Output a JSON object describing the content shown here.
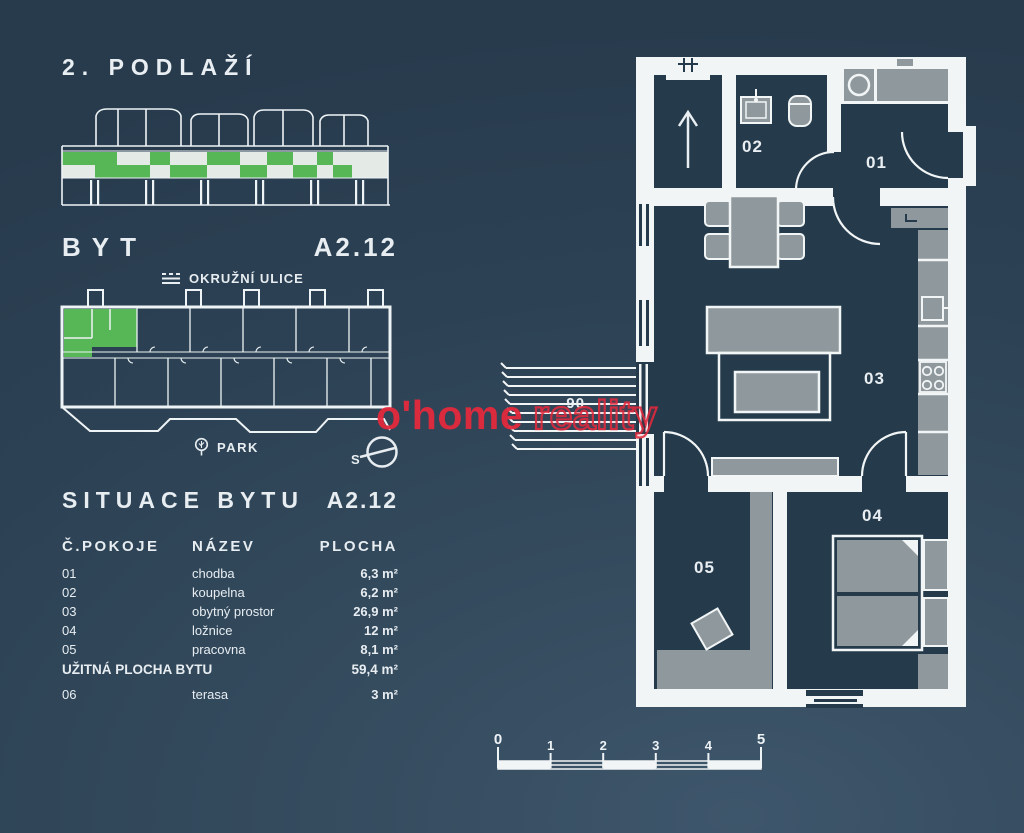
{
  "title": "2. PODLAŽÍ",
  "apartment": {
    "label": "BYT",
    "code": "A2.12"
  },
  "site": {
    "street": "OKRUŽNÍ ULICE",
    "park": "PARK",
    "compass_north": "S"
  },
  "situation": {
    "title": "SITUACE BYTU",
    "code": "A2.12"
  },
  "table": {
    "headers": {
      "room_no": "Č.POKOJE",
      "name": "NÁZEV",
      "area": "PLOCHA"
    },
    "rows": [
      {
        "num": "01",
        "name": "chodba",
        "area": "6,3 m²"
      },
      {
        "num": "02",
        "name": "koupelna",
        "area": "6,2 m²"
      },
      {
        "num": "03",
        "name": "obytný prostor",
        "area": "26,9 m²"
      },
      {
        "num": "04",
        "name": "ložnice",
        "area": "12 m²"
      },
      {
        "num": "05",
        "name": "pracovna",
        "area": "8,1 m²"
      }
    ],
    "total": {
      "label": "UŽITNÁ PLOCHA BYTU",
      "area": "59,4 m²"
    },
    "terrace": {
      "num": "06",
      "name": "terasa",
      "area": "3 m²"
    }
  },
  "floorplan": {
    "rooms": {
      "r01": "01",
      "r02": "02",
      "r03": "03",
      "r04": "04",
      "r05": "05",
      "r06": "06"
    }
  },
  "scalebar": {
    "labels": [
      "0",
      "1",
      "2",
      "3",
      "4",
      "5"
    ]
  },
  "watermark": {
    "brand": "o'home",
    "suffix": "reality",
    "color": "#e3293d"
  },
  "colors": {
    "background": "#2c4254",
    "wall_white": "#f2f5f6",
    "interior_dark": "#253a4b",
    "furniture_gray": "#8f999d",
    "accent_green": "#57b757",
    "watermark_red": "#e3293d"
  }
}
